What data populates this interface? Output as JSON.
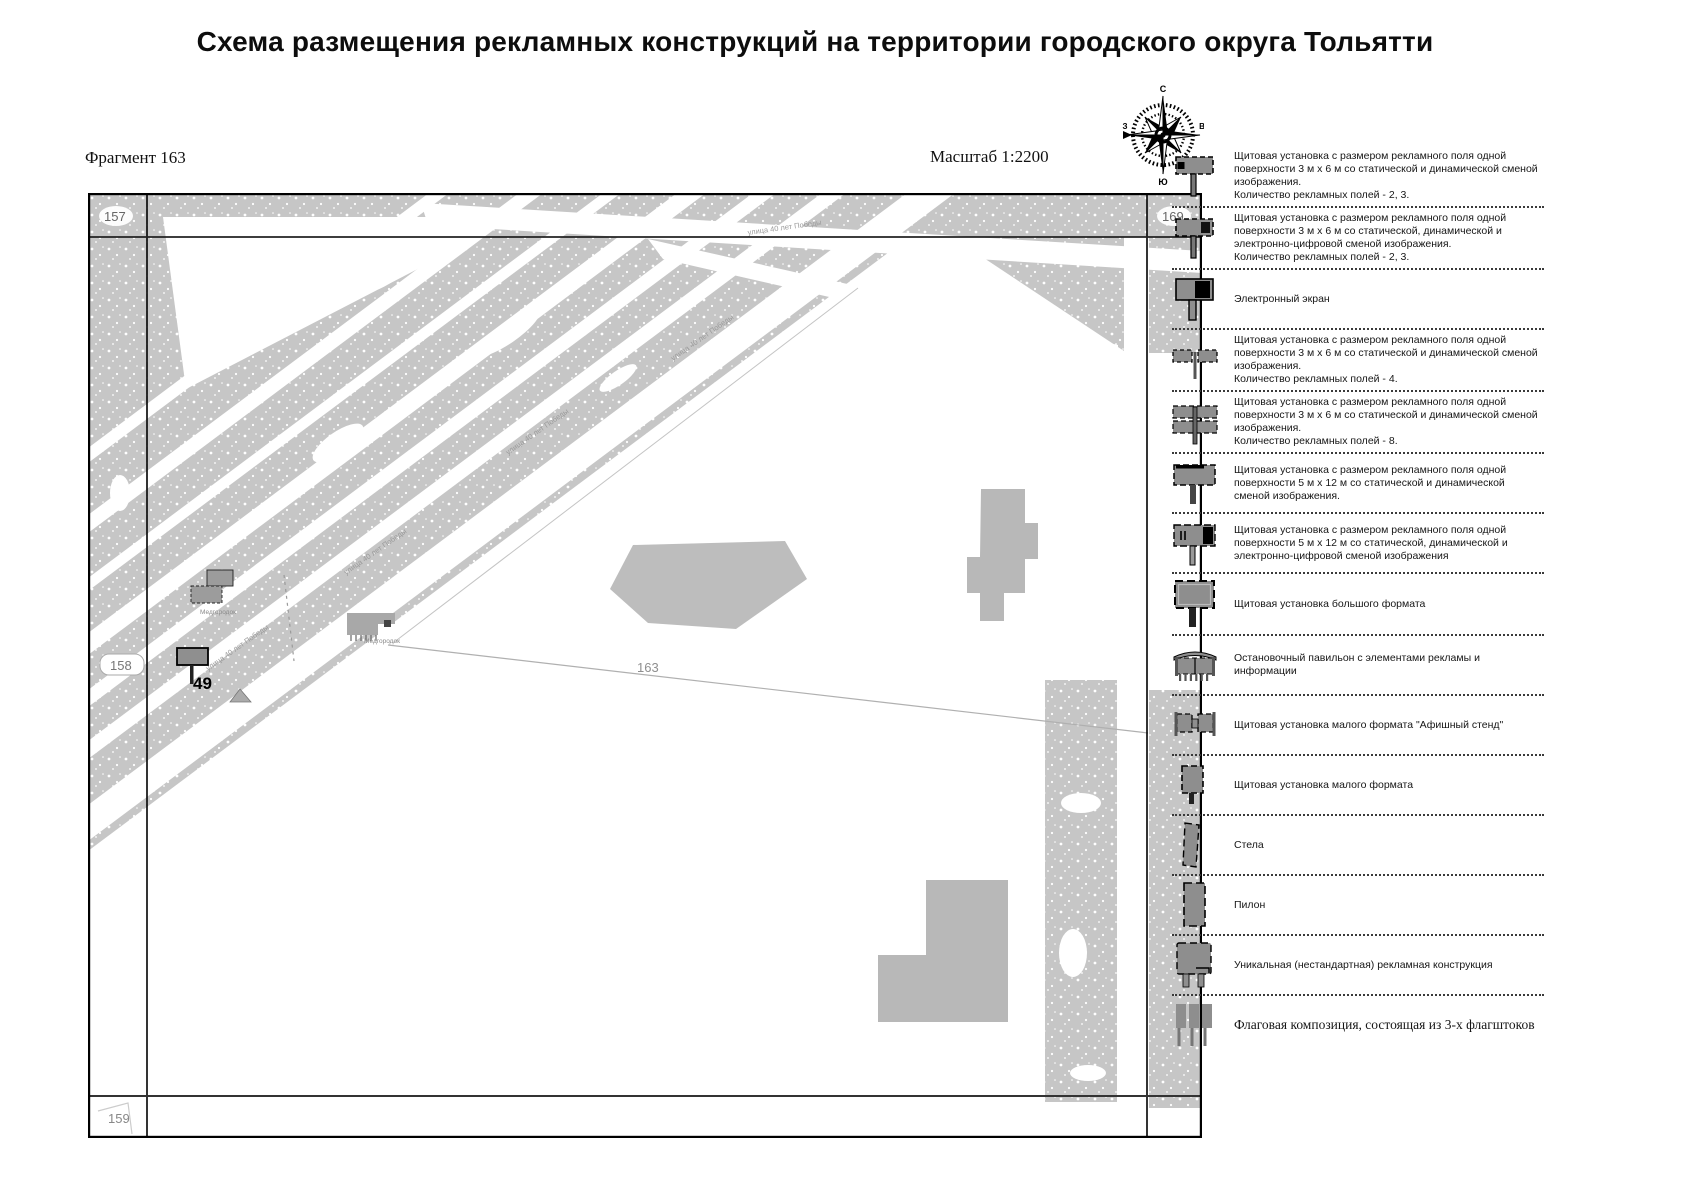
{
  "title": "Схема размещения рекламных конструкций на территории городского округа Тольятти",
  "map": {
    "fragment_label": "Фрагмент 163",
    "scale_label": "Масштаб 1:2200",
    "compass": {
      "north": "С",
      "south": "Ю",
      "east": "В",
      "west": "З"
    },
    "grid_labels": {
      "top_left": "157",
      "top_right": "169",
      "left": "158",
      "bottom_left": "159"
    },
    "parcel_number": "163",
    "construction_number": "49",
    "street_name": "улица 40 лет Победы",
    "building_label": "Медгородок"
  },
  "legend": {
    "items": [
      {
        "icon": "billboard-3x6-static-icon",
        "text": "Щитовая установка с размером рекламного поля одной поверхности 3 м х 6 м со статической и динамической сменой изображения.\nКоличество рекламных полей - 2, 3."
      },
      {
        "icon": "billboard-3x6-digital-icon",
        "text": "Щитовая установка с размером рекламного поля одной поверхности 3 м х 6 м со статической, динамической и электронно-цифровой сменой изображения.\nКоличество рекламных полей - 2, 3."
      },
      {
        "icon": "electronic-screen-icon",
        "text": "Электронный экран"
      },
      {
        "icon": "billboard-4-fields-icon",
        "text": "Щитовая установка с размером рекламного поля одной поверхности 3 м х 6 м со статической и динамической сменой изображения.\nКоличество рекламных полей - 4."
      },
      {
        "icon": "billboard-8-fields-icon",
        "text": "Щитовая установка с размером рекламного поля одной поверхности 3 м х 6 м со статической и динамической сменой изображения.\nКоличество рекламных полей - 8."
      },
      {
        "icon": "billboard-5x12-static-icon",
        "text": "Щитовая установка с размером рекламного поля одной поверхности 5 м х 12 м со статической и динамической сменой изображения."
      },
      {
        "icon": "billboard-5x12-digital-icon",
        "text": "Щитовая установка с размером рекламного поля одной поверхности 5 м х 12 м со статической, динамической и электронно-цифровой сменой изображения"
      },
      {
        "icon": "large-format-billboard-icon",
        "text": "Щитовая установка большого формата"
      },
      {
        "icon": "bus-stop-pavilion-icon",
        "text": "Остановочный павильон с элементами рекламы и информации"
      },
      {
        "icon": "poster-stand-icon",
        "text": "Щитовая установка малого формата \"Афишный стенд\""
      },
      {
        "icon": "small-format-billboard-icon",
        "text": "Щитовая установка малого формата"
      },
      {
        "icon": "stela-icon",
        "text": "Стела"
      },
      {
        "icon": "pylon-icon",
        "text": "Пилон"
      },
      {
        "icon": "unique-construction-icon",
        "text": "Уникальная (нестандартная) рекламная конструкция"
      },
      {
        "icon": "flag-composition-icon",
        "text": "Флаговая композиция, состоящая из 3-х флагштоков"
      }
    ]
  }
}
